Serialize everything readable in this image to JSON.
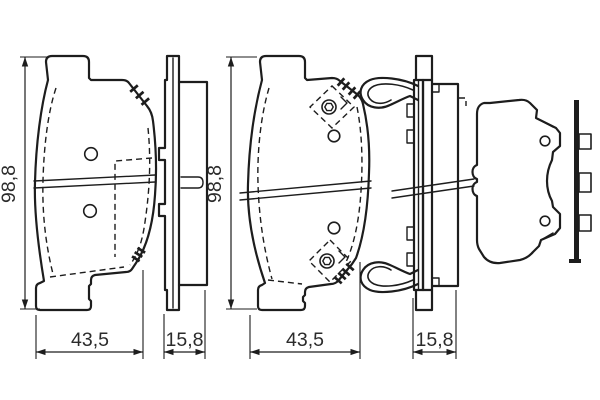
{
  "style": {
    "background": "#ffffff",
    "line_color": "#1d1d1d",
    "text_color": "#2b2b2b"
  },
  "views": {
    "pad1_front": {
      "height_label": "98,8",
      "width_label": "43,5"
    },
    "pad1_side": {
      "thickness_label": "15,8"
    },
    "pad2_front": {
      "height_label": "98,8",
      "width_label": "43,5"
    },
    "pad2_side": {
      "thickness_label": "15,8"
    }
  }
}
